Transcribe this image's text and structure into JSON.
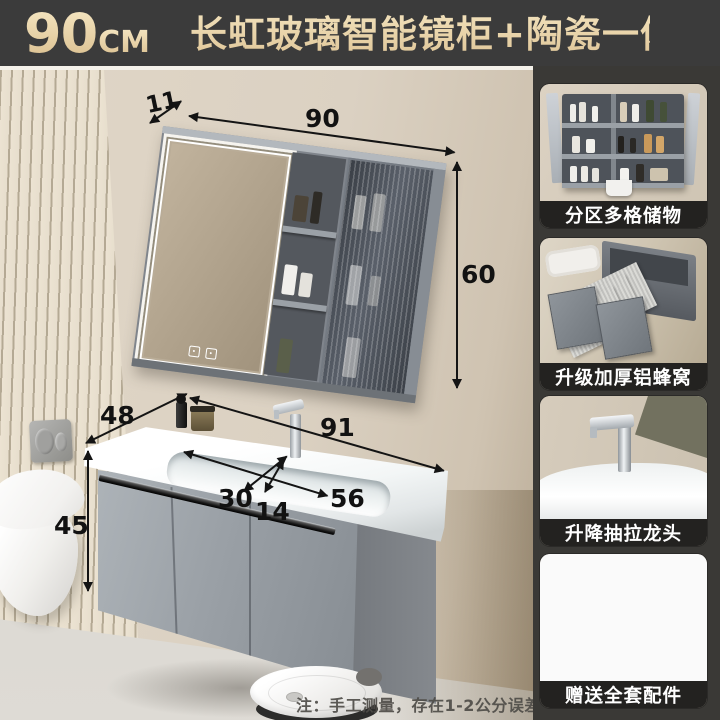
{
  "header": {
    "size_value": "90",
    "size_unit": "CM",
    "title": "长虹玻璃智能镜柜+陶瓷一体盆"
  },
  "scene": {
    "mirror_cabinet": {
      "depth_cm": "11",
      "width_cm": "90",
      "height_cm": "60"
    },
    "vanity": {
      "counter_depth_cm": "48",
      "counter_width_cm": "91",
      "cabinet_height_cm": "45",
      "basin_length_cm": "56",
      "basin_width_cm": "30",
      "basin_depth_cm": "14"
    }
  },
  "sidebar": {
    "cards": [
      {
        "caption": "分区多格储物"
      },
      {
        "caption": "升级加厚铝蜂窝"
      },
      {
        "caption": "升降抽拉龙头"
      },
      {
        "caption": "赠送全套配件"
      }
    ]
  },
  "footnote": "注：手工测量，存在1-2公分误差",
  "icons": {
    "mirror_controls": [
      "defogger-icon",
      "power-icon"
    ]
  },
  "colors": {
    "header_bg": "#3b3b3b",
    "title_gold": "#ead7ab",
    "sidebar_bg": "#3a3936",
    "caption_bg": "#232220",
    "dimension": "#141414"
  }
}
